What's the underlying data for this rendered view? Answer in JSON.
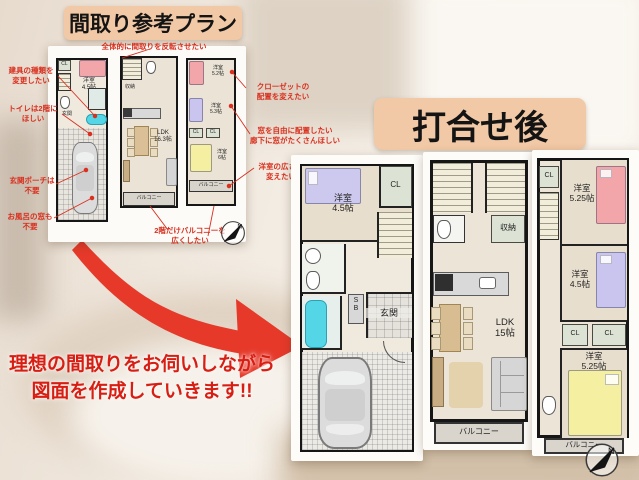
{
  "title_before": "間取り参考プラン",
  "title_after": "打合せ後",
  "note_top": "全体的に間取りを反転させたい",
  "note_left1": "建具の種類を\n変更したい",
  "note_left2": "トイレは2階に\nほしい",
  "note_left3": "玄関ポーチは\n不要",
  "note_left4": "お風呂の窓も\n不要",
  "note_right1": "クローゼットの\n配置を変えたい",
  "note_right2": "窓を自由に配置したい\n廊下に窓がたくさんほしい",
  "note_right3": "洋室の広さを\n変えたい",
  "note_bottom": "2階だけバルコニーを\n広くしたい",
  "caption": "理想の間取りをお伺いしながら\n図面を作成していきます!!",
  "compass_n": "N",
  "sp1": {
    "cl": "CL",
    "room": "洋室\n4.5帖",
    "genkan": "玄関"
  },
  "sp2": {
    "storage": "収納",
    "ldk": "LDK\n16.3帖",
    "balcony": "バルコニー"
  },
  "sp3": {
    "r1": "洋室\n5.2帖",
    "r2": "洋室\n5.3帖",
    "cl1": "CL",
    "cl2": "CL",
    "r3": "洋室\n6帖",
    "balcony": "バルコニー"
  },
  "lp1": {
    "room": "洋室\n4.5帖",
    "cl": "CL",
    "sb": "S\nB",
    "genkan": "玄関"
  },
  "lp2": {
    "storage": "収納",
    "ldk": "LDK\n15帖",
    "balcony": "バルコニー"
  },
  "lp3": {
    "cl0": "CL",
    "r1": "洋室\n5.25帖",
    "r2": "洋室\n4.5帖",
    "cl1": "CL",
    "cl2": "CL",
    "r3": "洋室\n5.25帖",
    "balcony": "バルコニー"
  },
  "colors": {
    "peach": "#f2c9a6",
    "red": "#d9301f",
    "arrow": "#e6392a",
    "bath_cyan": "#55d6e6",
    "bed_pink": "#f2a6aa",
    "bed_purple": "#c9c5ee",
    "bed_yellow": "#f5efa2"
  }
}
